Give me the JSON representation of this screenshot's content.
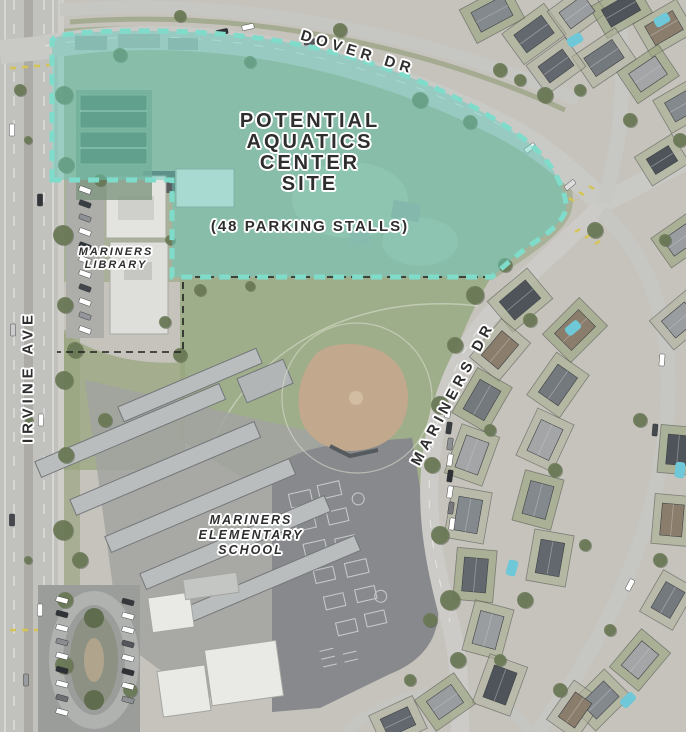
{
  "map": {
    "site_label": {
      "lines": [
        "POTENTIAL",
        "AQUATICS",
        "CENTER",
        "SITE"
      ],
      "subtitle": "(48 PARKING STALLS)"
    },
    "street_labels": {
      "dover": "DOVER DR",
      "irvine": "IRVINE AVE",
      "mariners": "MARINERS DR"
    },
    "place_labels": {
      "library_line1": "MARINERS",
      "library_line2": "LIBRARY",
      "school_line1": "MARINERS",
      "school_line2": "ELEMENTARY",
      "school_line3": "SCHOOL"
    },
    "colors": {
      "site_fill": "#63cdbb",
      "site_dash": "#7fdccb",
      "parcel_dash": "#1f1f1f",
      "label_text": "#2e2e2e",
      "label_halo": "#ffffff",
      "field_green": "#9fae8a",
      "road_gray": "#cac9c5",
      "pool_blue": "#6fc8d8",
      "infield_tan": "#c2a88c"
    }
  }
}
